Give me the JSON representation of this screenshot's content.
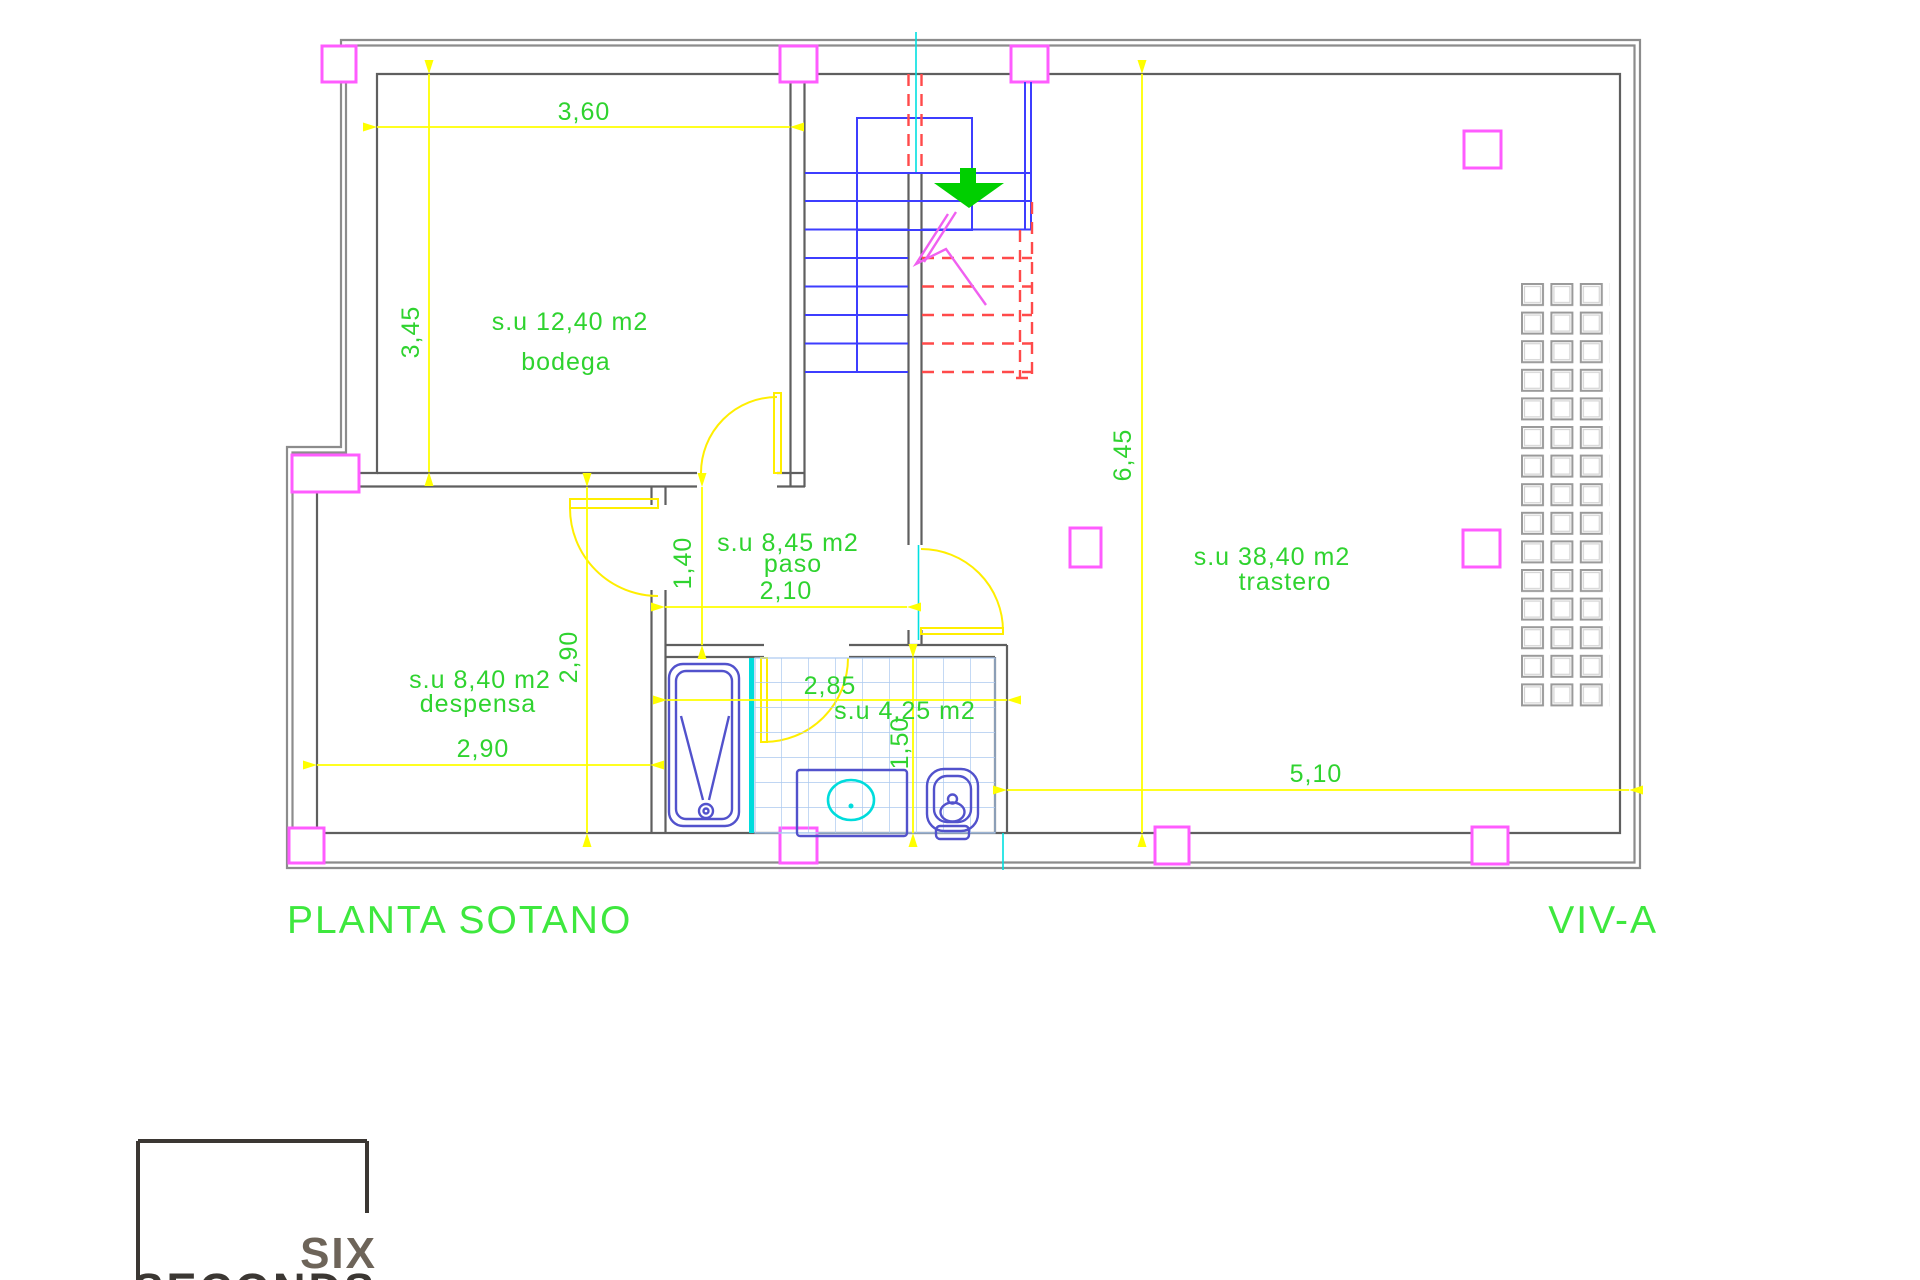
{
  "drawing": {
    "title": "PLANTA SOTANO",
    "sheet_code": "VIV-A"
  },
  "rooms": {
    "bodega": {
      "area": "s.u 12,40  m2",
      "name": "bodega"
    },
    "despensa": {
      "area": "s.u 8,40  m2",
      "name": "despensa"
    },
    "paso": {
      "area": "s.u 8,45  m2",
      "name": "paso"
    },
    "bathroom": {
      "area": "s.u 4,25  m2"
    },
    "trastero": {
      "area": "s.u 38,40  m2",
      "name": "trastero"
    }
  },
  "dimensions": {
    "bodega_width": "3,60",
    "bodega_height": "3,45",
    "despensa_height": "2,90",
    "despensa_width": "2,90",
    "paso_height": "1,40",
    "paso_width": "2,10",
    "bathroom_width": "2,85",
    "bathroom_height": "1,50",
    "trastero_height": "6,45",
    "trastero_width": "5,10"
  },
  "shelving": {
    "rows": 15,
    "cols": 3
  },
  "logo": {
    "line1": "SIX",
    "line2": "SECONDS"
  },
  "colors": {
    "dimension_lines": "#ffff00",
    "annotation_text": "#2fd32f",
    "walls": "#5f5f5f",
    "stairs": "#3d3dff",
    "hidden_stairs": "#ff4a4a",
    "columns": "#ff5cff",
    "centerlines": "#00e0e0",
    "fixtures": "#5252cc",
    "tiles": "#abc9ef",
    "basin": "#00dcdc",
    "direction_arrow": "#00cf00",
    "logo_text": "#6d6459",
    "logo_box": "#3b3733"
  }
}
